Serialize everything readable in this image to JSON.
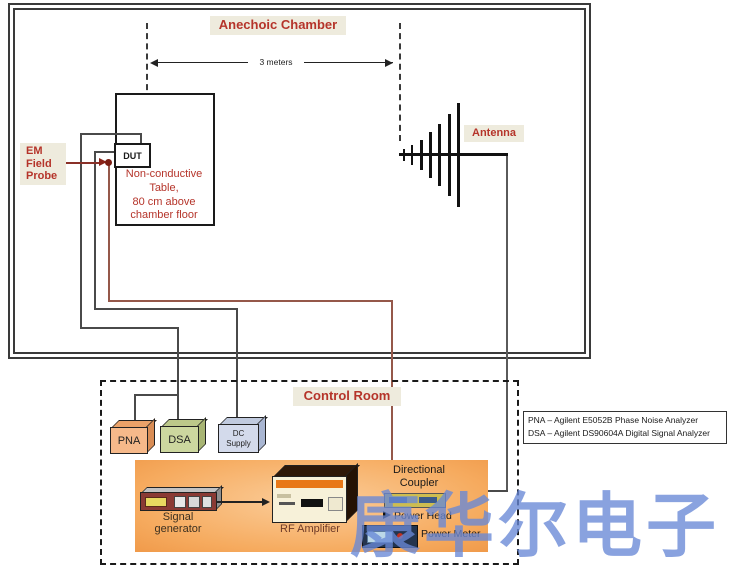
{
  "chamber": {
    "title": "Anechoic Chamber",
    "distance": "3 meters",
    "dut": "DUT",
    "probe_lines": [
      "EM",
      "Field",
      "Probe"
    ],
    "table_lines": [
      "Non-conductive",
      "Table,",
      "80 cm above",
      "chamber floor"
    ],
    "antenna": "Antenna"
  },
  "control_room": {
    "title": "Control Room",
    "pna": "PNA",
    "dsa": "DSA",
    "dc_lines": [
      "DC",
      "Supply"
    ],
    "signal_generator": "Signal generator",
    "rf_amplifier": "RF Amplifier",
    "coupler_lines": [
      "Directional",
      "Coupler"
    ],
    "power_head": "Power Head",
    "power_meter": "Power Meter"
  },
  "legend": {
    "lines": [
      "PNA – Agilent E5052B Phase Noise Analyzer",
      "DSA – Agilent DS90604A Digital Signal Analyzer"
    ]
  },
  "watermark": {
    "text": "康华尔电子"
  },
  "colors": {
    "label_red": "#b5342a",
    "label_bg": "#eeebdd",
    "wire_dark": "#4a4a4a",
    "wire_brown": "#95584a",
    "panel_orange": "#f6ab5f",
    "watermark_blue": "#6888d6"
  }
}
